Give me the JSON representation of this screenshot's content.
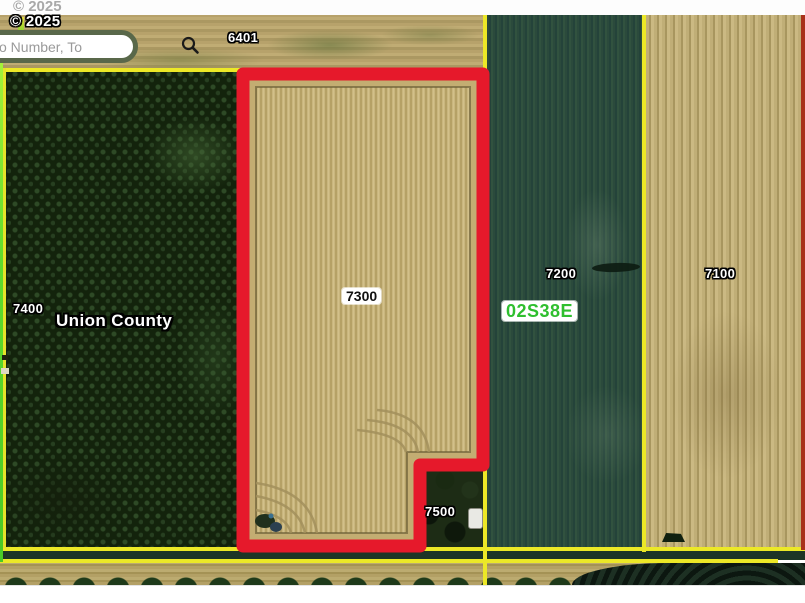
{
  "app": {
    "name": "county-parcel-map-viewer"
  },
  "attribution": {
    "bar_text": "© 2025",
    "map_text": "© 2025"
  },
  "search": {
    "placeholder": "o Number, To",
    "value": ""
  },
  "labels": {
    "county": "Union County",
    "township": "02S38E"
  },
  "parcels": [
    {
      "id": "6401",
      "selected": false
    },
    {
      "id": "7400",
      "selected": false
    },
    {
      "id": "7300",
      "selected": true
    },
    {
      "id": "7200",
      "selected": false
    },
    {
      "id": "7100",
      "selected": false
    },
    {
      "id": "7500",
      "selected": false
    }
  ],
  "colors": {
    "selection_outline": "#e6192b",
    "parcel_boundary": "#ece827",
    "county_boundary": "#5fdc2c",
    "township_label_text": "#2fbf2f",
    "search_border": "#59684a"
  }
}
